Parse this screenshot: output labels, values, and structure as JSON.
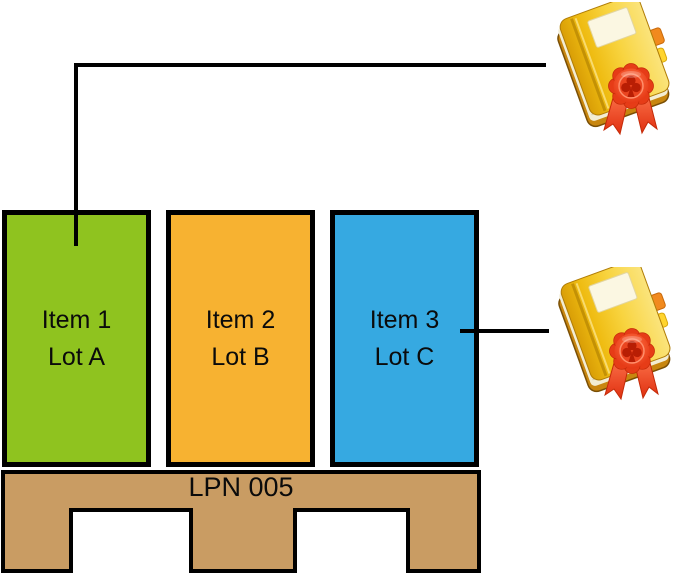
{
  "items": [
    {
      "name": "Item 1",
      "lot": "Lot A",
      "fill_color": "#8FC31F"
    },
    {
      "name": "Item 2",
      "lot": "Lot B",
      "fill_color": "#F7B231"
    },
    {
      "name": "Item 3",
      "lot": "Lot C",
      "fill_color": "#36A9E1"
    }
  ],
  "pallet": {
    "label": "LPN 005",
    "fill_color": "#C99C63"
  },
  "connectors": {
    "color": "#000000"
  },
  "certificates": [
    {
      "icon": "certificate-book-icon",
      "attached_to": "Item 1 Lot A"
    },
    {
      "icon": "certificate-book-icon",
      "attached_to": "Item 3 Lot C"
    }
  ]
}
